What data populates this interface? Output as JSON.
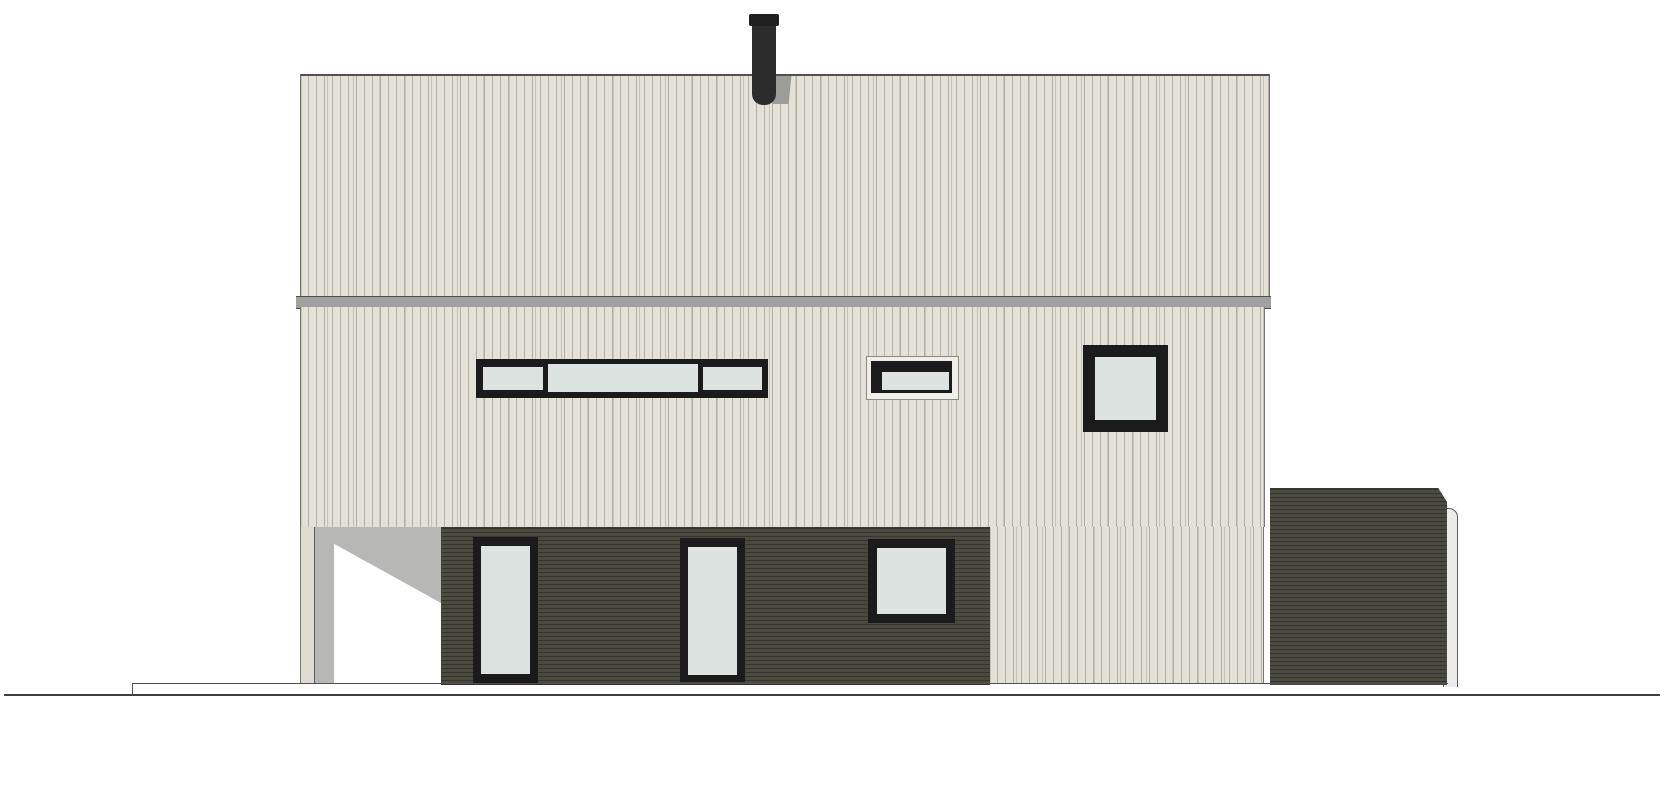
{
  "meta": {
    "type": "architectural-elevation-drawing",
    "subject": "two-storey house side elevation with carport recess and annex",
    "visible_text": []
  },
  "colors": {
    "background": "#ffffff",
    "cream_siding": "#e3e1d8",
    "siding_line": "#b3b0a5",
    "dark_cladding": "#4a4a41",
    "window_frame": "#1b1b1b",
    "glass": "#dce3e0",
    "band_gray": "#a0a09e",
    "shadow_gray": "#b7b7b5",
    "chimney_dark": "#2c2c2c",
    "line_dark": "#4f4f4f"
  },
  "elements": {
    "roof_panel": "upper sloped roof face with vertical seam cladding",
    "eave_band": "horizontal gray fascia band between roof and wall",
    "chimney": "dark flue pipe with cap at roof centre",
    "upper_wall": "cream vertical-board wall, middle level",
    "ribbon_window": "three-pane horizontal ribbon window, black frame",
    "trim_window": "small horizontal window with light trim surround",
    "mid_square_window": "square window, black frame, middle level right",
    "lower_wall": "dark horizontal-board clad ground level",
    "carport_recess": "open recessed corner with shadow at lower left",
    "low_window_1": "tall narrow glazed door/window, lower level",
    "low_window_2": "tall narrow glazed door/window, lower level",
    "low_square_window": "square window in dark cladding, lower level",
    "annex": "dark-clad annex/garage volume at right with downpipe",
    "ground": "ground line and foundation slab edge"
  }
}
